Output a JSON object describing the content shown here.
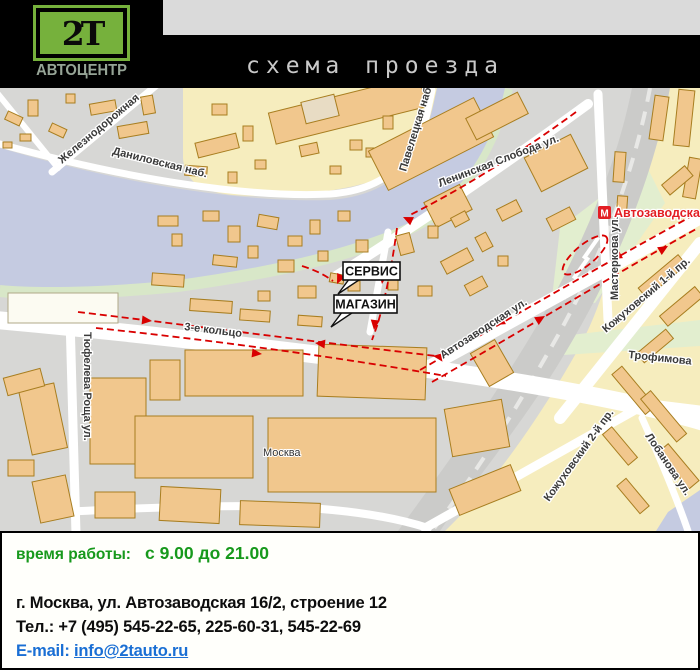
{
  "header": {
    "logo_text": "2Т",
    "logo_subtitle": "АВТОЦЕНТР",
    "title": "схема проезда"
  },
  "map": {
    "labels": {
      "zheleznodorozhnaya": "Железнодорожная",
      "danilovskaya": "Даниловская наб.",
      "paveletskaya": "Павелецкая наб.",
      "leninskaya": "Ленинская Слобода ул.",
      "masterkova": "Мастеркова ул.",
      "avtozavodskaya_ul": "Автозаводская ул.",
      "kozhukhovsky1": "Кожуховский 1-й пр.",
      "kozhukhovsky2": "Кожуховский 2-й пр.",
      "trofimova": "Трофимова",
      "lobanova": "Лобанова ул.",
      "third_ring": "3-е кольцо",
      "tyufeleva": "Тюфелева Роща ул.",
      "moskva": "Москва"
    },
    "metro": {
      "m": "М",
      "name": "Автозаводская"
    },
    "callouts": {
      "service": "СЕРВИС",
      "shop": "МАГАЗИН"
    },
    "colors": {
      "land": "#d7d7d5",
      "yellow_zone": "#f6edbe",
      "river": "#c5cbe1",
      "green": "#d8e7c8",
      "building": "#f1c78d",
      "building_outline": "#a87e20",
      "route_red": "#d90000",
      "metro_red": "#e31e24"
    }
  },
  "info": {
    "hours_label": "время работы:",
    "hours_value": "с 9.00 до 21.00",
    "address": "г. Москва, ул. Автозаводская 16/2, строение 12",
    "phone": "Тел.: +7 (495) 545-22-65, 225-60-31, 545-22-69",
    "email_label": "E-mail:",
    "email": "info@2tauto.ru",
    "colors": {
      "hours_green": "#17991c",
      "link_blue": "#1a6fd4"
    }
  }
}
